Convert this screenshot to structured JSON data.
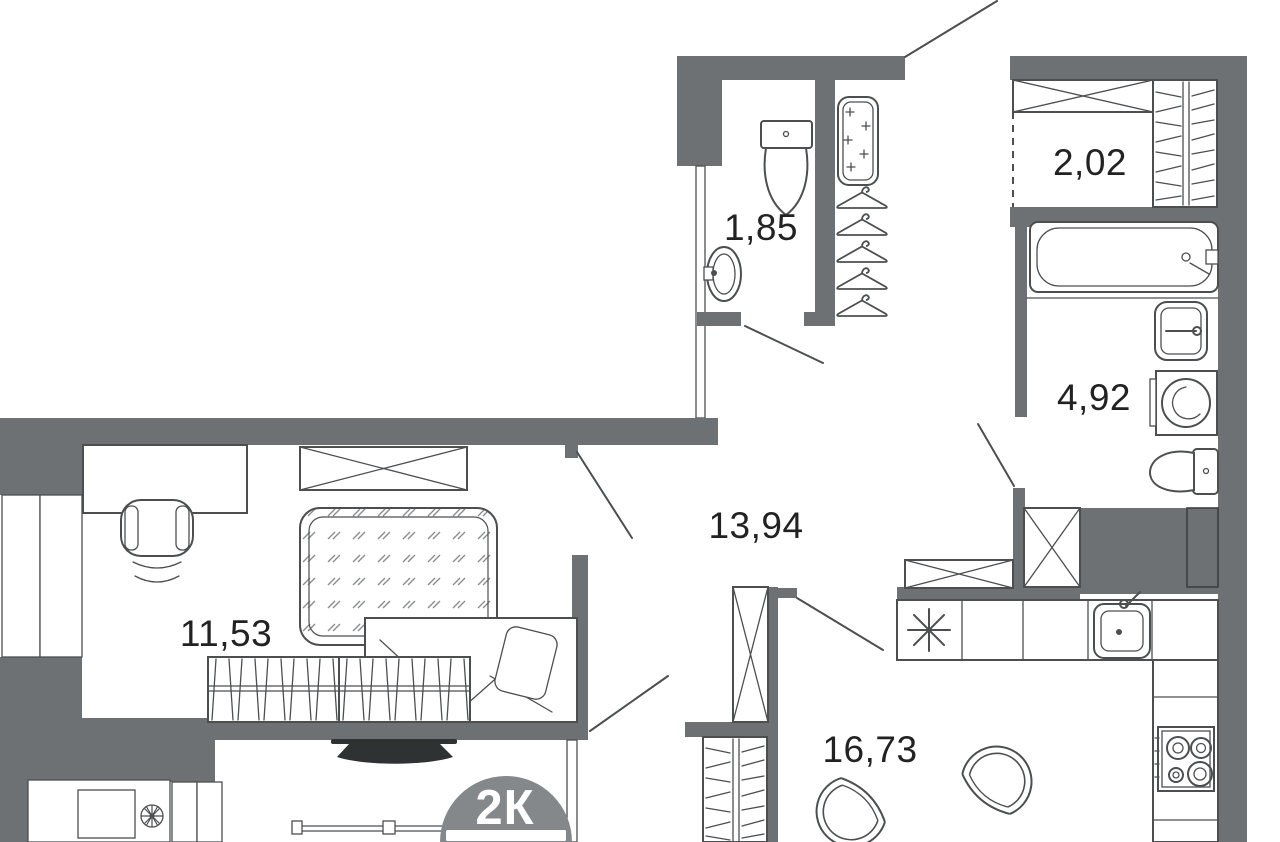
{
  "plan": {
    "type": "apartment-floor-plan",
    "badge": {
      "label": "2К"
    },
    "rooms": {
      "bedroom": {
        "area": "11,53"
      },
      "hallway": {
        "area": "13,94"
      },
      "wc": {
        "area": "1,85"
      },
      "dressing": {
        "area": "2,02"
      },
      "bathroom": {
        "area": "4,92"
      },
      "kitchen_living": {
        "area": "16,73"
      }
    },
    "fixtures": [
      "toilet-icon",
      "wash-basin-icon",
      "bathtub-icon",
      "washing-machine-icon",
      "mirror-icon",
      "coat-hanger-icon",
      "wardrobe-icon",
      "shelving-icon",
      "fridge-snowflake-icon",
      "kitchen-sink-icon",
      "stove-icon",
      "armchair-icon",
      "bed-icon",
      "carpet-icon",
      "desk-icon",
      "desk-chair-icon",
      "tv-icon",
      "radiator-icon",
      "fan-icon",
      "balcony-rail-icon",
      "door-swing-icon",
      "window-icon",
      "duct-shaft-icon"
    ],
    "colors": {
      "wall": "#6e7173",
      "line": "#4c4e50",
      "label": "#222222",
      "badge": "#85888a"
    }
  }
}
